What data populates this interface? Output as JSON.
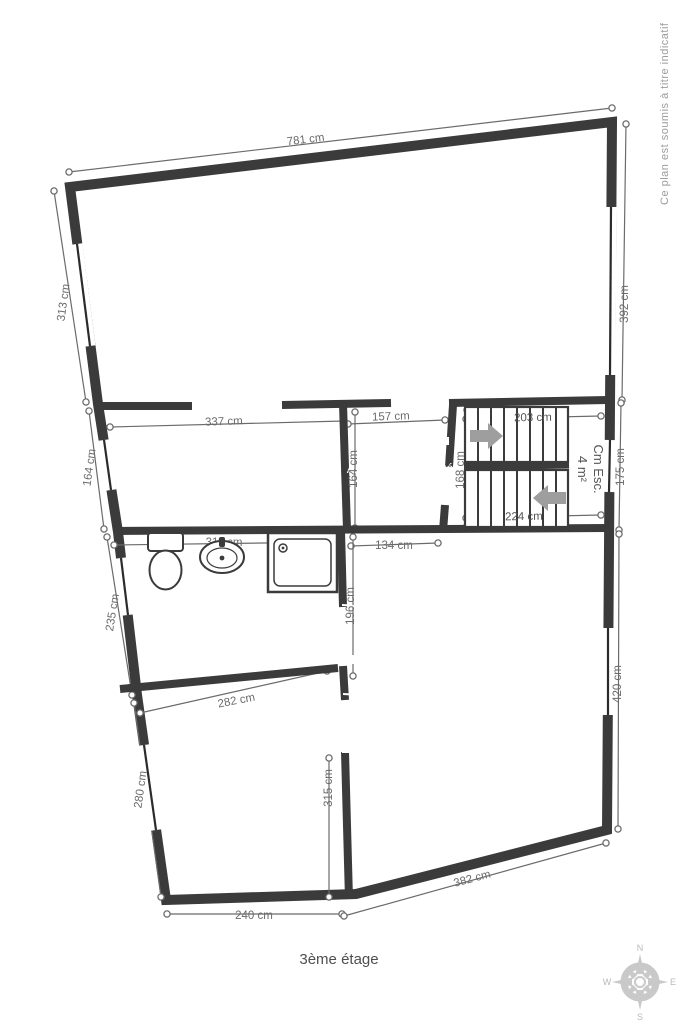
{
  "floor_title": "3ème étage",
  "disclaimer": "Ce plan est soumis à titre indicatif",
  "rooms": [
    {
      "name": "App 4 séjour",
      "area": "26 m²"
    },
    {
      "name": "App 4 Cuisine",
      "area": "5 m²"
    },
    {
      "name": "App 4 Hall d'entrée",
      "area": "2 m²"
    },
    {
      "name": "Cm Esc.",
      "area": "4 m²"
    },
    {
      "name": "App 4 Salle douche",
      "area": "6 m²"
    },
    {
      "name": "App 4 Chambre 1",
      "area": "17 m²"
    },
    {
      "name": "App 4 Chambre 2",
      "area": "8 m²"
    }
  ],
  "dimensions": {
    "top": "781 cm",
    "left_sejour": "313 cm",
    "left_cuisine": "164 cm",
    "left_salle_douche": "235 cm",
    "left_chambre2": "280 cm",
    "right_sejour": "392 cm",
    "right_esc": "175 cm",
    "right_chambre1": "420 cm",
    "cuisine_width": "337 cm",
    "hall_width": "157 cm",
    "esc_upper": "203 cm",
    "esc_lower": "224 cm",
    "hall_height": "164 cm",
    "esc_height": "168 cm",
    "hall_bottom": "134 cm",
    "salle_douche_width": "311 cm",
    "salle_douche_height": "196 cm",
    "chambre2_width": "282 cm",
    "chambre2_height": "315 cm",
    "chambre2_bottom": "240 cm",
    "chambre1_bottom": "382 cm"
  },
  "compass": {
    "n": "N",
    "e": "E",
    "s": "S",
    "w": "W"
  },
  "colors": {
    "floor": "#2aa7da",
    "wall": "#3b3b3b",
    "dimension_text": "#6b6b6b",
    "room_text": "#ffffff",
    "compass": "#c9c9c9"
  }
}
